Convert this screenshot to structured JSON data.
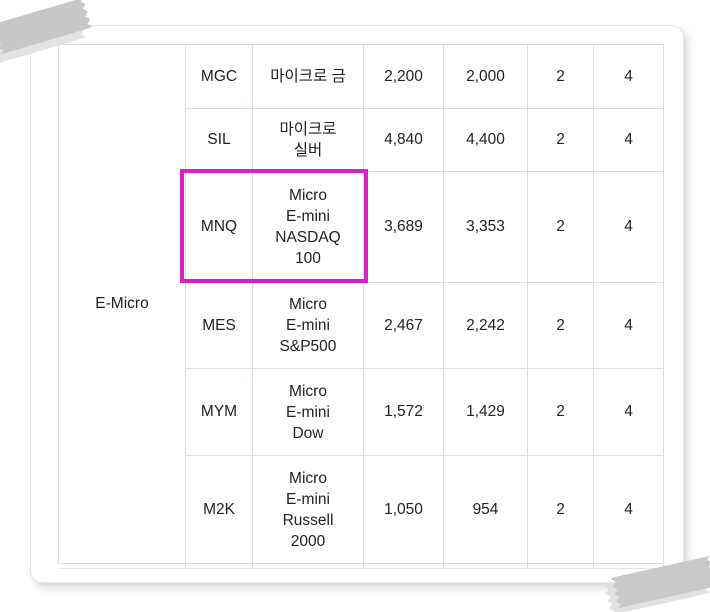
{
  "card": {
    "group_label": "E-Micro",
    "table": {
      "rows": [
        {
          "code": "MGC",
          "name": "마이크로 금",
          "val1": "2,200",
          "val2": "2,000",
          "val3": "2",
          "val4": "4",
          "highlighted": false
        },
        {
          "code": "SIL",
          "name": "마이크로\n실버",
          "val1": "4,840",
          "val2": "4,400",
          "val3": "2",
          "val4": "4",
          "highlighted": false
        },
        {
          "code": "MNQ",
          "name": "Micro\nE-mini\nNASDAQ\n100",
          "val1": "3,689",
          "val2": "3,353",
          "val3": "2",
          "val4": "4",
          "highlighted": true
        },
        {
          "code": "MES",
          "name": "Micro\nE-mini\nS&P500",
          "val1": "2,467",
          "val2": "2,242",
          "val3": "2",
          "val4": "4",
          "highlighted": false
        },
        {
          "code": "MYM",
          "name": "Micro\nE-mini\nDow",
          "val1": "1,572",
          "val2": "1,429",
          "val3": "2",
          "val4": "4",
          "highlighted": false
        },
        {
          "code": "M2K",
          "name": "Micro\nE-mini\nRussell\n2000",
          "val1": "1,050",
          "val2": "954",
          "val3": "2",
          "val4": "4",
          "highlighted": false
        }
      ]
    }
  },
  "colors": {
    "highlight_box": "#DA1FC8",
    "table_border": "#DBDCE6",
    "tape": "#C7C7C7"
  }
}
